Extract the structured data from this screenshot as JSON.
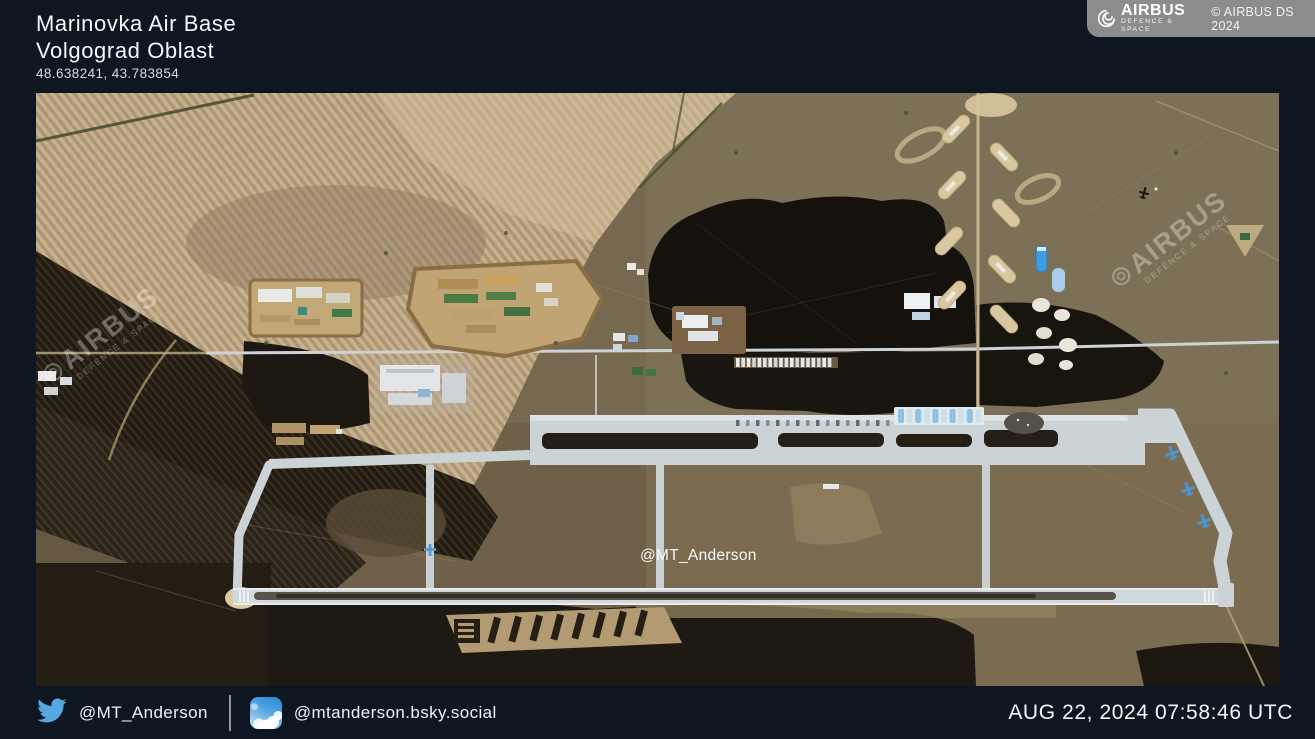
{
  "header": {
    "title_line1": "Marinovka Air Base",
    "title_line2": "Volgograd Oblast",
    "coordinates": "48.638241, 43.783854"
  },
  "credit": {
    "brand": "AIRBUS",
    "brand_sub": "DEFENCE & SPACE",
    "copyright": "© AIRBUS DS 2024"
  },
  "image": {
    "watermark": {
      "brand": "AIRBUS",
      "sub": "DEFENCE & SPACE"
    },
    "center_handle": "@MT_Anderson"
  },
  "footer": {
    "twitter_handle": "@MT_Anderson",
    "bluesky_handle": "@mtanderson.bsky.social",
    "timestamp": "AUG 22, 2024 07:58:46 UTC"
  },
  "colors": {
    "background": "#0e1621",
    "twitter_blue": "#55a8e0",
    "credit_gray": "#8a8c8e",
    "runway_gray": "#d2d9dd",
    "farmland_tan": "#c8b18e",
    "burn_black": "#15120d"
  }
}
